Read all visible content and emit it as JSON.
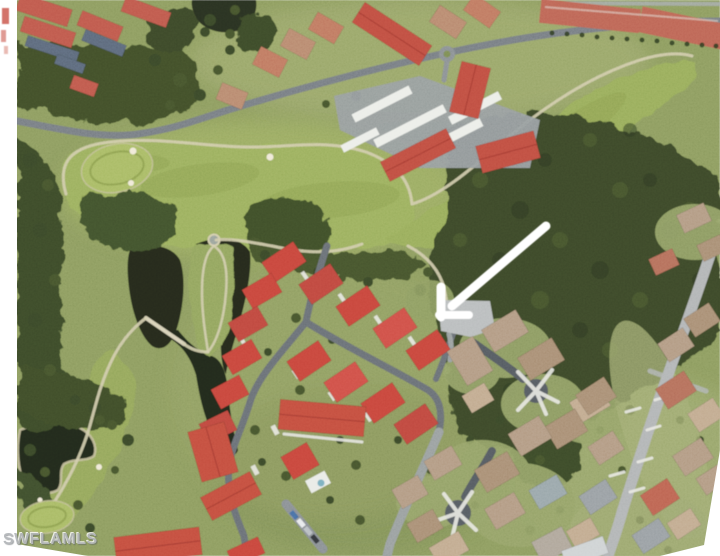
{
  "page": {
    "title": "Aerial property photo",
    "type": "aerial-photo"
  },
  "watermark": {
    "text": "SWFLAMLS",
    "color": "#b4b7ba"
  },
  "annotations": {
    "arrow": {
      "name": "location-arrow",
      "color": "#ffffff",
      "direction": "pointing-southwest",
      "target": "property location at neighborhood entrance near cul-de-sac"
    }
  },
  "scene": {
    "features": [
      "golf fairway",
      "golf greens",
      "sand bunkers",
      "two dark lakes",
      "dense tree stands",
      "red-roof home cluster",
      "tan-roof cul-de-sac homes",
      "condo buildings with white carports",
      "curving streets",
      "white location arrow",
      "MLS watermark"
    ],
    "palette": {
      "canvas_white": "#ffffff",
      "grass_green": "#8d9c60",
      "fairway_green": "#9cb05f",
      "tree_dark_green": "#3c4a2a",
      "water_dark": "#252c1d",
      "road_gray": "#70767c",
      "road_light_gray": "#b2b5b6",
      "cart_path_tan": "#d3cdad",
      "roof_red": "#c8473d",
      "roof_salmon": "#bf5a4d",
      "roof_tan": "#b39b84",
      "roof_blue_gray": "#5d6b7c",
      "driveway_white": "#e9e9e4",
      "arrow_white": "#ffffff",
      "watermark_gray": "#b4b7ba"
    }
  }
}
